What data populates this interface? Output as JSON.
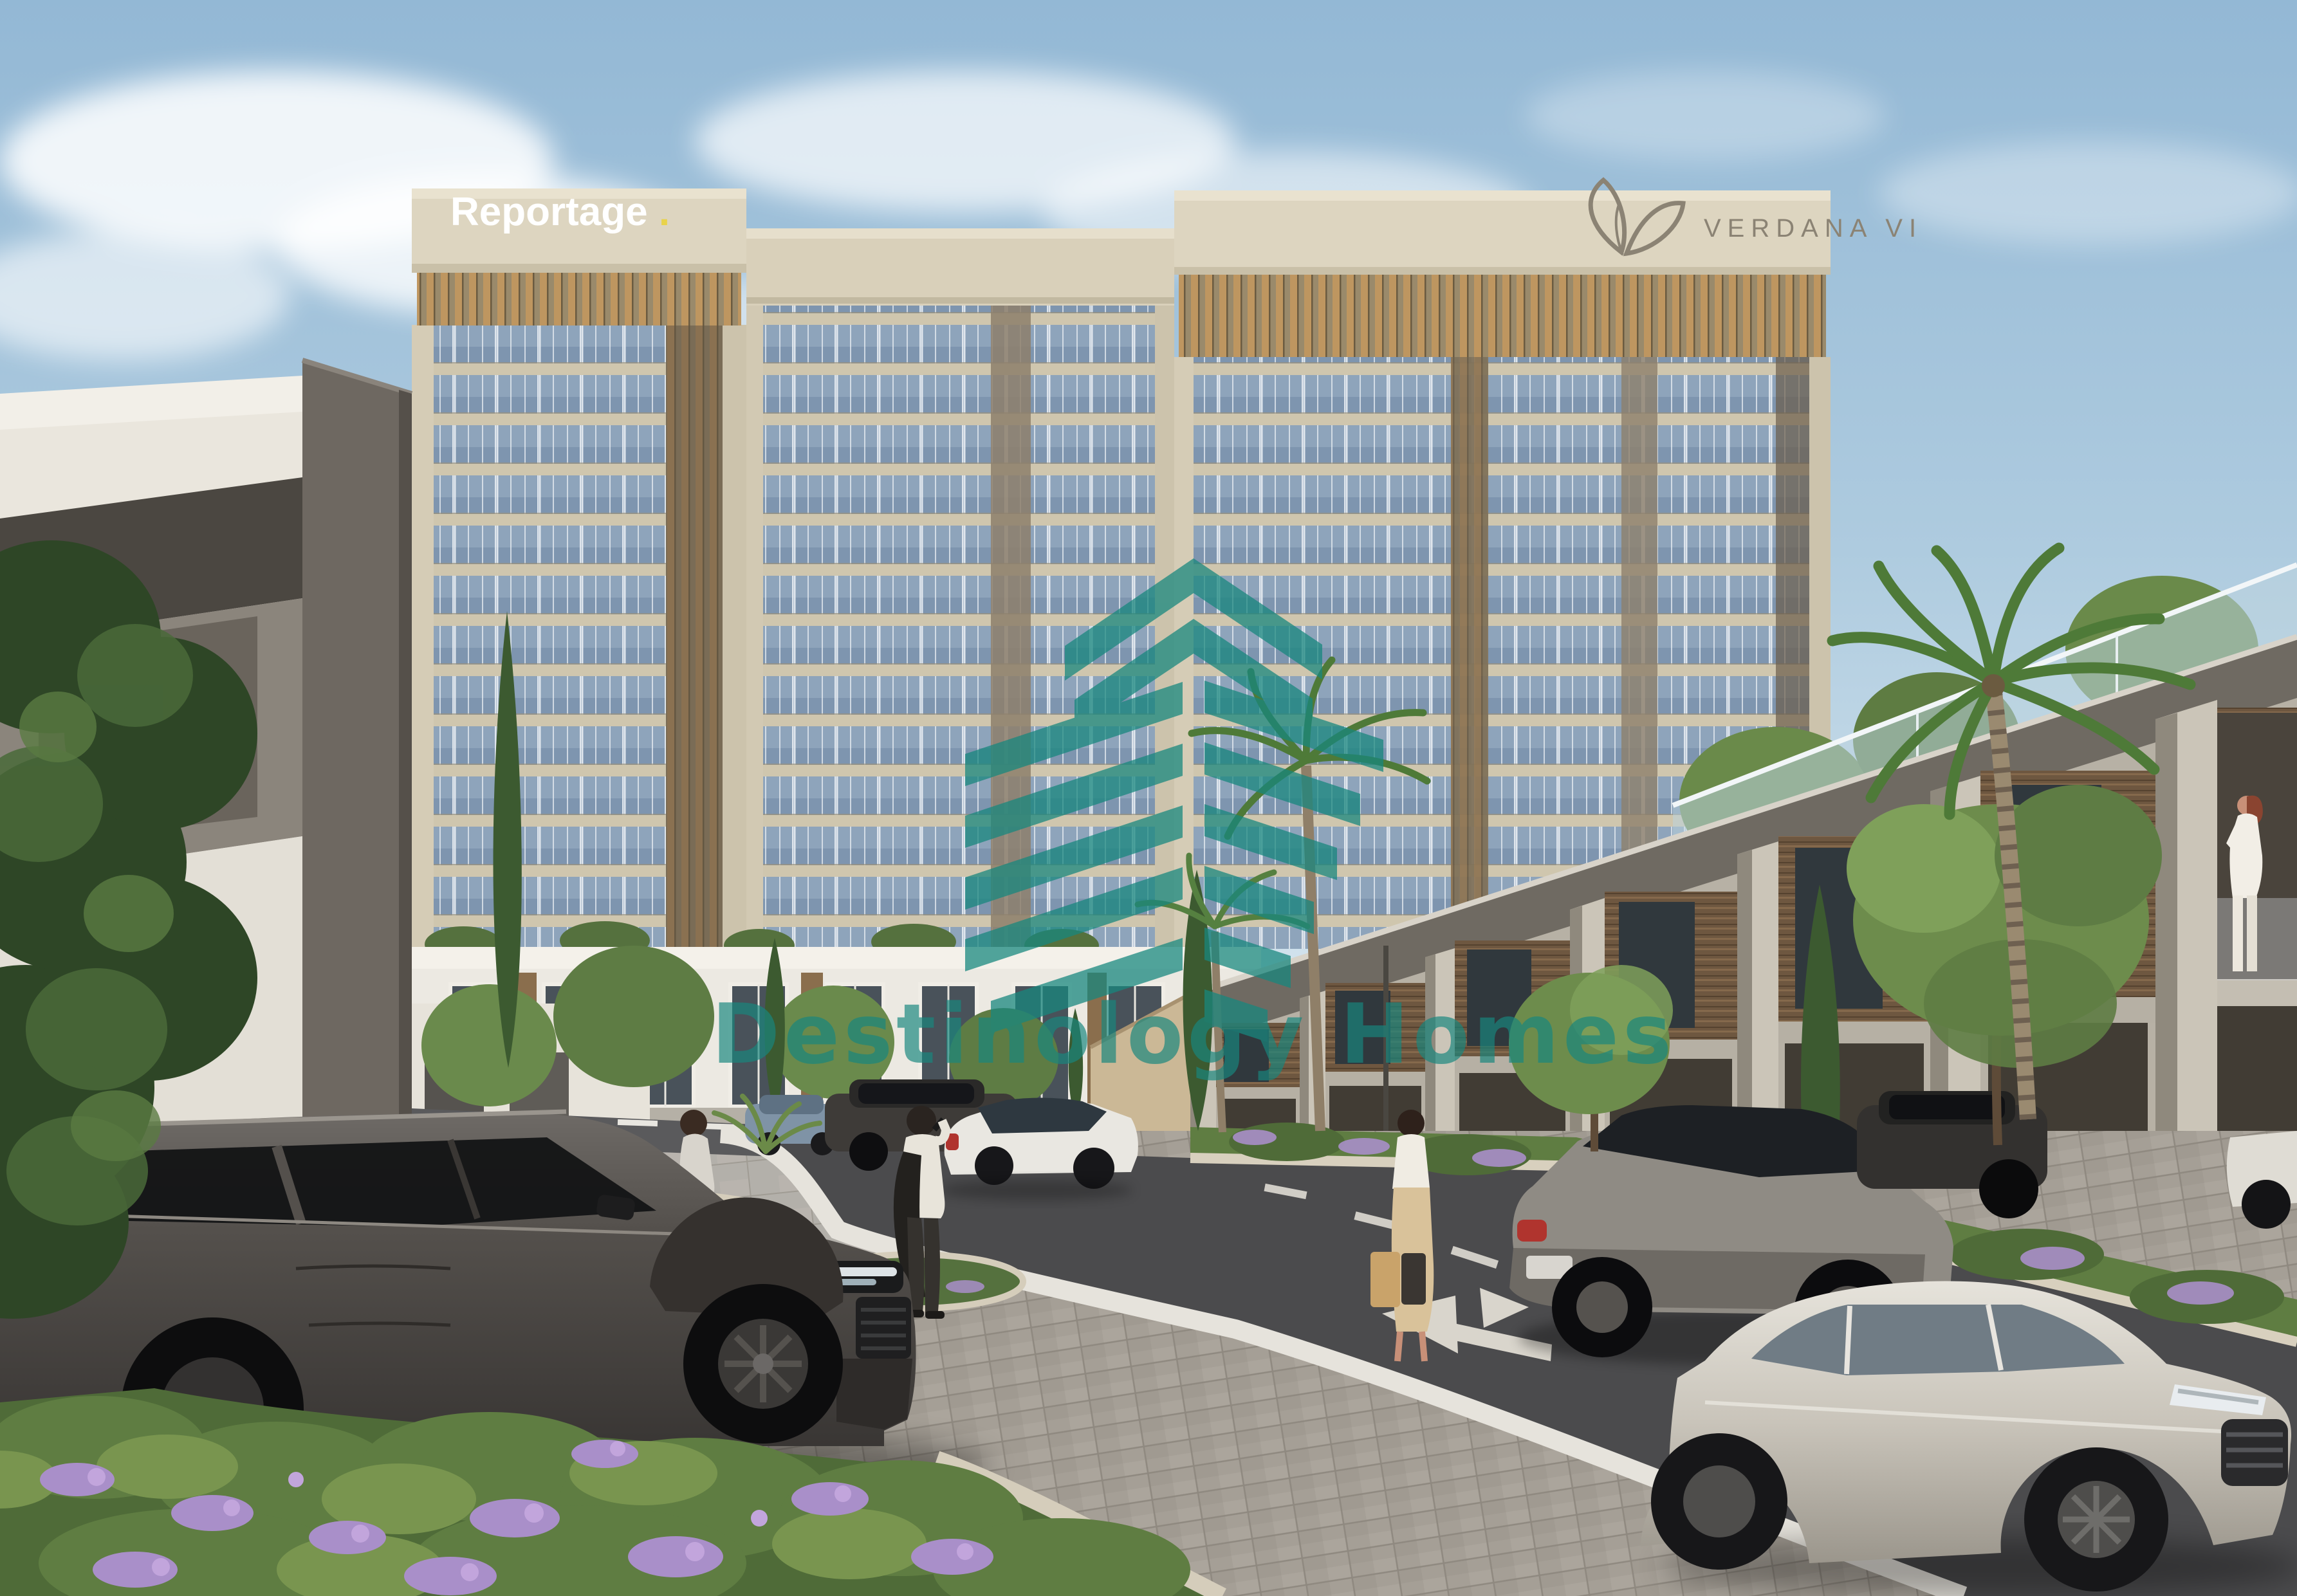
{
  "scene": {
    "description": "Street-level architectural rendering of a residential community: three beige mid-rise apartment towers behind rows of modern townhouses, landscaped street with cars, cyclists and pedestrians",
    "signs": {
      "reportage_word": "Reportage",
      "reportage_dot": ".",
      "verdana_label": "VERDANA VI"
    },
    "watermark": {
      "text": "Destinology Homes",
      "color": "#18877E"
    },
    "palette": {
      "sky_top": "#9ABDD8",
      "sky_horizon": "#E3EEF4",
      "tower_stone": "#D9D0BA",
      "tower_glass": "#7E95AF",
      "wood_louver": "#BE9660",
      "townhouse_white": "#ECE9E2",
      "wood_slats": "#6E5740",
      "concrete": "#B7B1A5",
      "asphalt": "#4B4B4D",
      "pavers": "#A59F96",
      "foliage": "#5F7D42",
      "flowers": "#A98FC9",
      "suv_dark": "#474340",
      "sedan_silver": "#C9C4BA"
    }
  }
}
